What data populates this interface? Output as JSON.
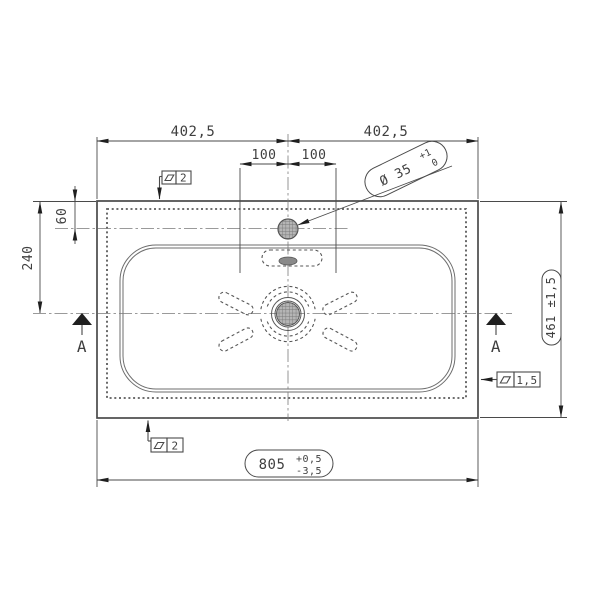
{
  "drawing": {
    "type": "technical-drawing",
    "view": "washbasin top view with section A-A markers",
    "dims": {
      "width_left": "402,5",
      "width_right": "402,5",
      "hole_offset_left": "100",
      "hole_offset_right": "100",
      "deck_to_faucet": "60",
      "deck_to_drain": "240",
      "overall_depth": "461 ±1,5",
      "overall_width_value": "805",
      "overall_width_tol_plus": "+0,5",
      "overall_width_tol_minus": "-3,5",
      "faucet_hole_dia": "Ø 35",
      "faucet_hole_tol_plus": "+1",
      "faucet_hole_tol_minus": "0"
    },
    "gdt": {
      "flatness_top_value": "2",
      "flatness_bottom_value": "2",
      "flatness_right_value": "1,5",
      "symbol": "flatness-parallelogram"
    },
    "section": {
      "left_label": "A",
      "right_label": "A"
    },
    "colors": {
      "background": "#ffffff",
      "outline": "#4a4a4a",
      "thin": "#6e6e6e",
      "hidden": "#565656",
      "glue": "#5a5a5a",
      "centerline": "#7a7a7a",
      "dimline": "#4a4a4a",
      "text": "#3f3f3f",
      "arrow": "#1f1f1f",
      "hatch_fill": "#b5b5b5",
      "hatch_line": "#787878",
      "overflow_fill": "#8a8a8a"
    }
  }
}
